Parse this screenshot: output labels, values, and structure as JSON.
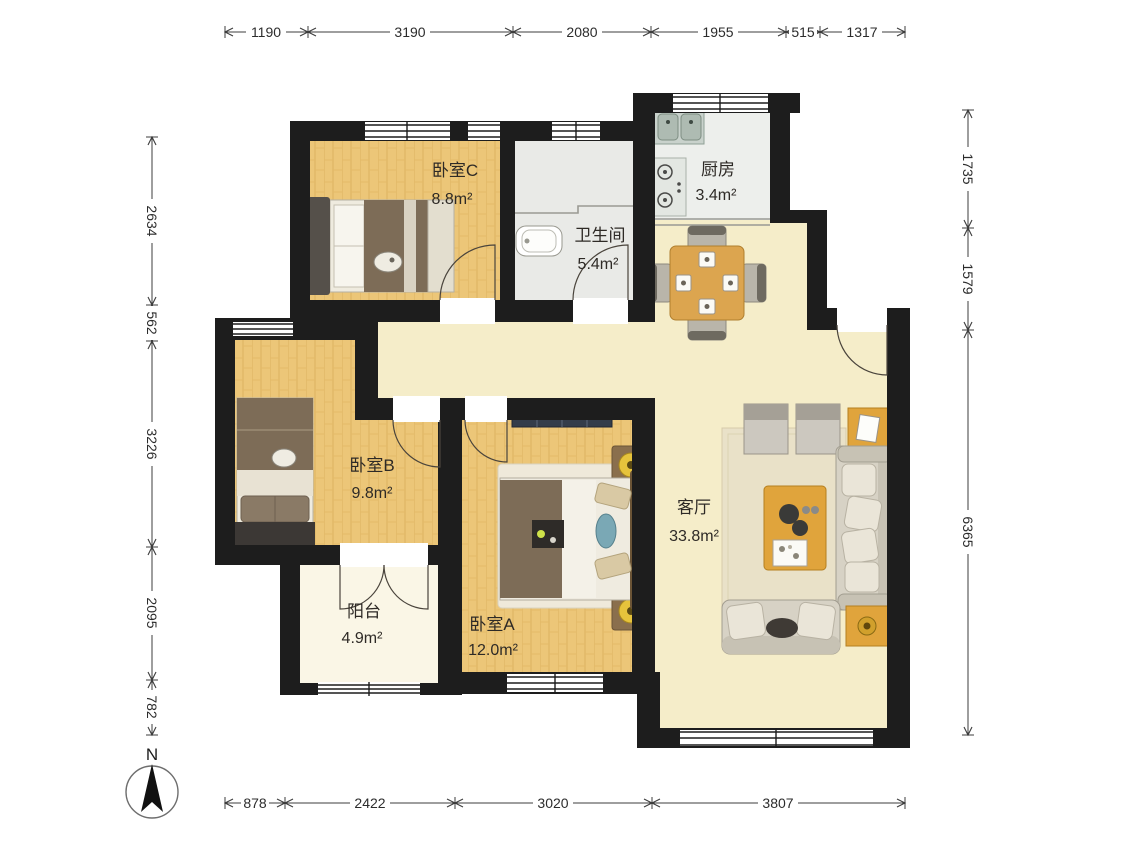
{
  "title": "apartment-floor-plan",
  "compass": {
    "label": "N"
  },
  "rooms": {
    "bedroom_c": {
      "name": "卧室C",
      "area": "8.8m²"
    },
    "bathroom": {
      "name": "卫生间",
      "area": "5.4m²"
    },
    "kitchen": {
      "name": "厨房",
      "area": "3.4m²"
    },
    "bedroom_b": {
      "name": "卧室B",
      "area": "9.8m²"
    },
    "living_room": {
      "name": "客厅",
      "area": "33.8m²"
    },
    "bedroom_a": {
      "name": "卧室A",
      "area": "12.0m²"
    },
    "balcony": {
      "name": "阳台",
      "area": "4.9m²"
    }
  },
  "dimensions_mm": {
    "top": [
      "1190",
      "3190",
      "2080",
      "1955",
      "515",
      "1317"
    ],
    "left": [
      "2634",
      "562",
      "3226",
      "2095",
      "782"
    ],
    "right": [
      "1735",
      "1579",
      "6365"
    ],
    "bottom": [
      "878",
      "2422",
      "3020",
      "3807"
    ]
  },
  "furniture": {
    "bedroom_c": "double-bed",
    "bedroom_b": "double-bed",
    "bedroom_a": "double-bed, nightstands with lamps, wardrobe",
    "living_room": "sofa, loveseat, coffee table, side tables, ottomans, rug",
    "dining": "square table with four chairs",
    "kitchen": "double sink, two-burner stove",
    "bathroom": "washbasin"
  },
  "colors": {
    "wall": "#1d1d1d",
    "wood_floor": "#ecc678",
    "tile_floor": "#e9eae7",
    "living_floor": "#f5edc9",
    "balcony_floor": "#faf6e6",
    "accent_table": "#e0a43c",
    "fabric": "#d7d2c5",
    "blanket": "#7d6c57"
  }
}
